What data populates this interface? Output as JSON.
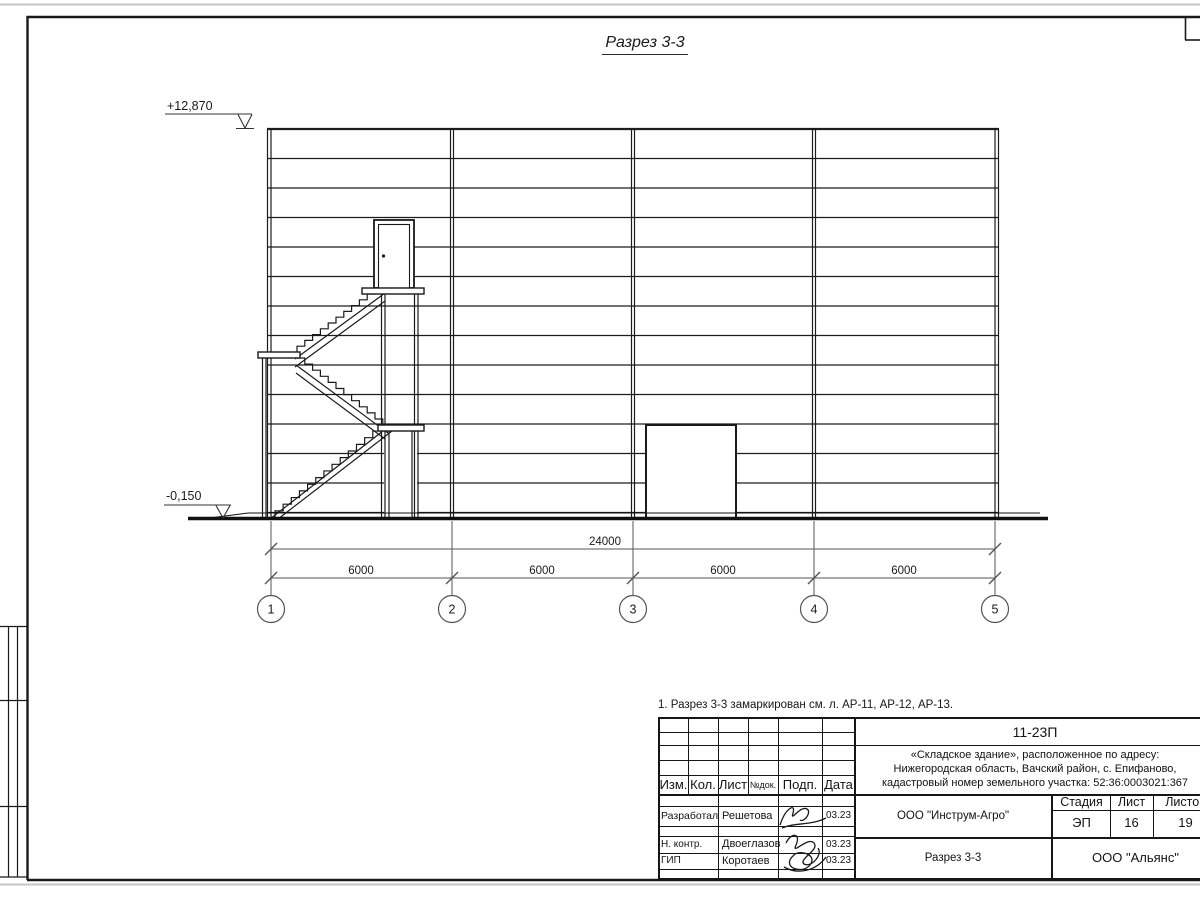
{
  "drawing": {
    "title": "Разрез 3-3",
    "note": "1. Разрез 3-3 замаркирован см. л. АР-11, АР-12, АР-13.",
    "elevation_top": "+12,870",
    "elevation_bottom": "-0,150",
    "dim_total": "24000",
    "dim_spans": [
      "6000",
      "6000",
      "6000",
      "6000"
    ],
    "axes": [
      "1",
      "2",
      "3",
      "4",
      "5"
    ]
  },
  "titleblock": {
    "doc_number": "11-23П",
    "project_line1": "«Складское здание», расположенное по адресу:",
    "project_line2": "Нижегородская область, Вачский район, с. Епифаново,",
    "project_line3": "кадастровый номер земельного участка: 52:36:0003021:367",
    "header": {
      "izm": "Изм.",
      "kol": "Кол.",
      "list": "Лист",
      "ndok": "№док.",
      "podp": "Подп.",
      "data": "Дата"
    },
    "rows": [
      {
        "role": "Разработал",
        "name": "Решетова",
        "date": "03.23"
      },
      {
        "role": "Н. контр.",
        "name": "Двоеглазов",
        "date": "03.23"
      },
      {
        "role": "ГИП",
        "name": "Коротаев",
        "date": "03.23"
      }
    ],
    "org": "ООО \"Инструм-Агро\"",
    "sheet_name": "Разрез 3-3",
    "stage_label": "Стадия",
    "list_label": "Лист",
    "listov_label": "Листов",
    "stage": "ЭП",
    "sheet_no": "16",
    "sheet_total": "19",
    "company": "ООО \"Альянс\""
  }
}
